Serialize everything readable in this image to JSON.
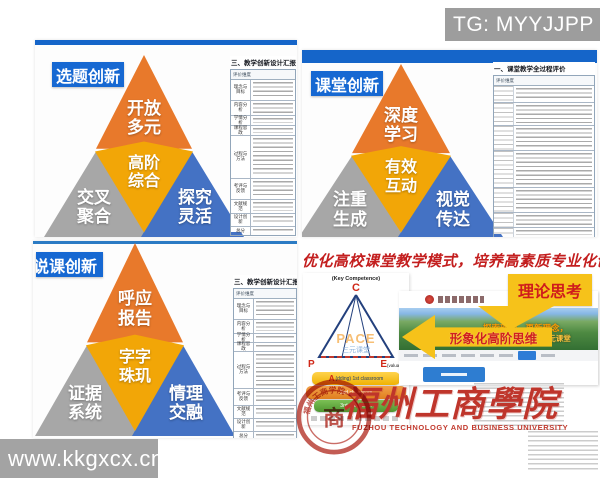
{
  "watermarks": {
    "telegram": "TG: MYYJJPP",
    "site": "www.kkgxcx.cn"
  },
  "badges": {
    "topic": "选题创新",
    "classroom": "课堂创新",
    "lecture": "说课创新"
  },
  "pyramids": {
    "topic": {
      "top": [
        "开放",
        "多元"
      ],
      "mid": [
        "高阶",
        "综合"
      ],
      "left": [
        "交叉",
        "聚合"
      ],
      "right": [
        "探究",
        "灵活"
      ]
    },
    "classroom": {
      "top": [
        "深度",
        "学习"
      ],
      "mid": [
        "有效",
        "互动"
      ],
      "left": [
        "注重",
        "生成"
      ],
      "right": [
        "视觉",
        "传达"
      ]
    },
    "lecture": {
      "top": [
        "呼应",
        "报告"
      ],
      "mid": [
        "字字",
        "珠玑"
      ],
      "left": [
        "证据",
        "系统"
      ],
      "right": [
        "情理",
        "交融"
      ]
    }
  },
  "tables": {
    "design": {
      "title": "三、教学创新设计汇报",
      "header": "评价维度",
      "rows": [
        "理念与目标",
        "内容分析",
        "学情分析",
        "课程思政",
        "过程与方法",
        "考评与反馈",
        "文献规范",
        "设计创新",
        "总分"
      ]
    },
    "classroom": {
      "title": "一、课堂教学全过程评价",
      "header": "评价维度"
    }
  },
  "summary": {
    "title": "优化高校课堂教学模式，培养高素质专业化创新",
    "pace": {
      "key_label": "(Key Competence)",
      "c": "C",
      "word": "PACE",
      "word_sub": "三元课堂",
      "p": "P",
      "e": "E",
      "e_suffix": "(valuation)",
      "a": "A",
      "layer1": "(dding) 1st classroom",
      "layer2": "2nd classroom",
      "layer3": "3rd classroom"
    },
    "arrows": {
      "theory": "理论思考",
      "visual": "形象化高阶思维"
    },
    "site": {
      "slogan1": "探索理论，更新理念，",
      "slogan2": "共享PACE要素的三元课堂"
    },
    "university": {
      "cn": "福州工商學院",
      "en": "FUZHOU TECHNOLOGY AND BUSINESS UNIVERSITY",
      "seal_text": "福州工商学院",
      "seal_glyph": "商"
    }
  }
}
